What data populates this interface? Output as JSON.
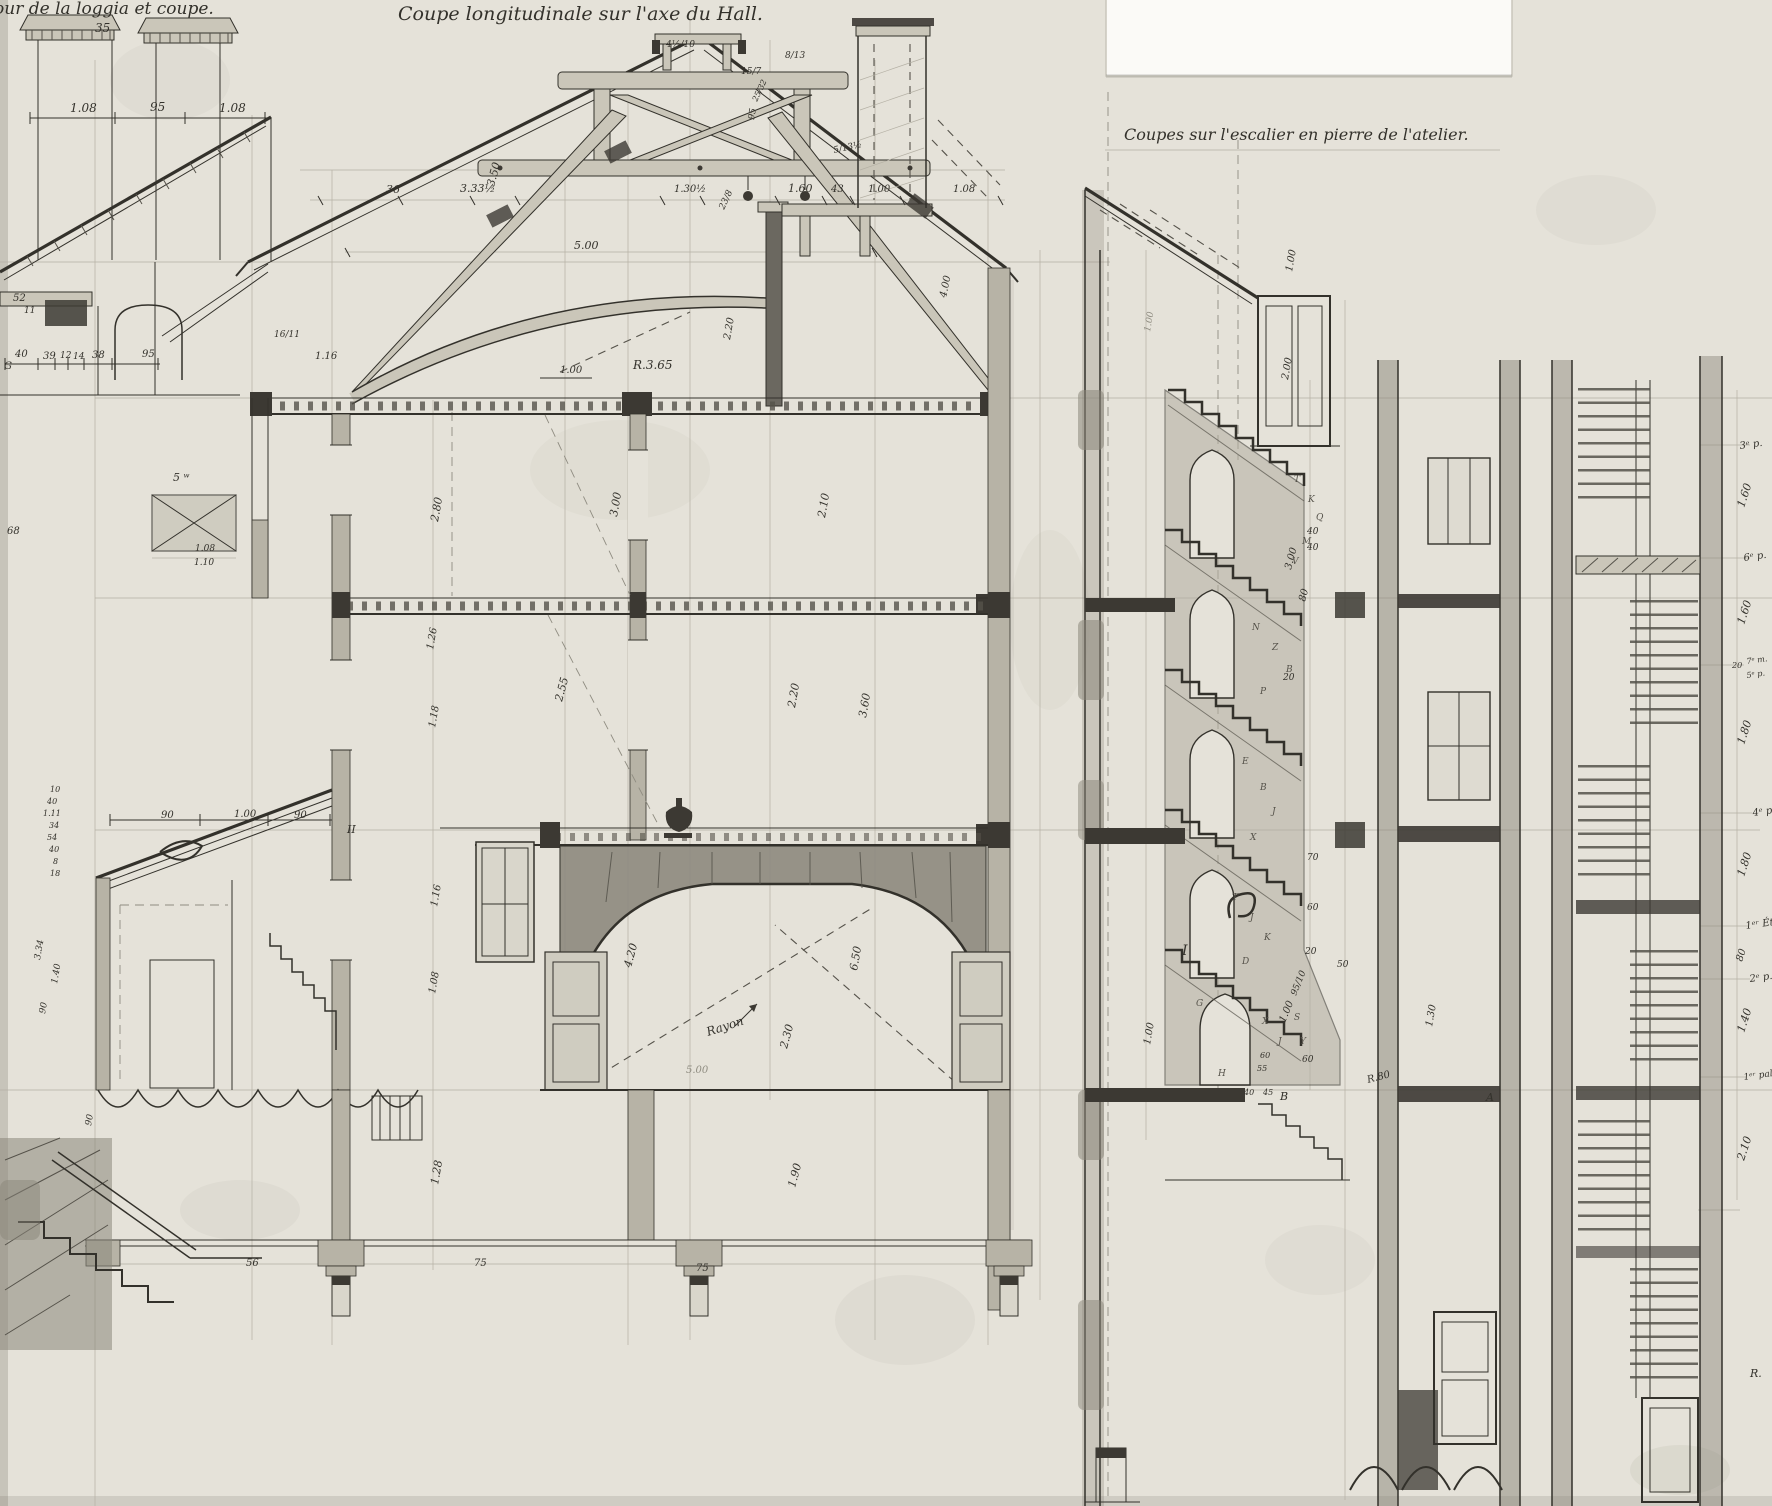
{
  "titles": {
    "left": "Tour de la loggia et coupe.",
    "center": "Coupe longitudinale sur l'axe du Hall.",
    "right": "Coupes sur l'escalier en pierre de l'atelier."
  },
  "colors": {
    "paper": "#e5e2d9",
    "ink": "#33312b",
    "wash": "#8a867a",
    "wood": "#cac6b9",
    "stone": "#b3afa2",
    "dark_fill": "#3c3933",
    "white_patch": "#fbfaf7"
  },
  "labels": [
    {
      "t": "35",
      "x": 95,
      "y": 32,
      "s": 12
    },
    {
      "t": "1.08",
      "x": 70,
      "y": 112,
      "s": 12
    },
    {
      "t": "95",
      "x": 150,
      "y": 111,
      "s": 12
    },
    {
      "t": "1.08",
      "x": 219,
      "y": 112,
      "s": 12
    },
    {
      "t": "52",
      "x": 13,
      "y": 301,
      "s": 10
    },
    {
      "t": "11",
      "x": 24,
      "y": 313,
      "s": 9
    },
    {
      "t": "G",
      "x": 4,
      "y": 369,
      "s": 10
    },
    {
      "t": "40",
      "x": 15,
      "y": 357,
      "s": 10
    },
    {
      "t": "39",
      "x": 43,
      "y": 359,
      "s": 10
    },
    {
      "t": "12",
      "x": 60,
      "y": 358,
      "s": 9
    },
    {
      "t": "14",
      "x": 73,
      "y": 359,
      "s": 9
    },
    {
      "t": "38",
      "x": 92,
      "y": 358,
      "s": 10
    },
    {
      "t": "95",
      "x": 142,
      "y": 357,
      "s": 10
    },
    {
      "t": "5 ʷ",
      "x": 173,
      "y": 481,
      "s": 11
    },
    {
      "t": "68",
      "x": 7,
      "y": 534,
      "s": 10
    },
    {
      "t": "1.08",
      "x": 195,
      "y": 551,
      "s": 9
    },
    {
      "t": "1.10",
      "x": 194,
      "y": 565,
      "s": 9
    },
    {
      "t": "36",
      "x": 386,
      "y": 193,
      "s": 11
    },
    {
      "t": "3.33½",
      "x": 460,
      "y": 192,
      "s": 11
    },
    {
      "t": "3.50",
      "x": 494,
      "y": 187,
      "r": -75,
      "s": 11
    },
    {
      "t": "1.30½",
      "x": 674,
      "y": 192,
      "s": 10
    },
    {
      "t": "1.60",
      "x": 788,
      "y": 192,
      "s": 11
    },
    {
      "t": "43",
      "x": 831,
      "y": 192,
      "s": 10
    },
    {
      "t": "1.00",
      "x": 868,
      "y": 192,
      "s": 10
    },
    {
      "t": "1.08",
      "x": 953,
      "y": 192,
      "s": 10
    },
    {
      "t": "5.00",
      "x": 574,
      "y": 249,
      "s": 11
    },
    {
      "t": "4.00",
      "x": 946,
      "y": 298,
      "r": -78,
      "s": 10
    },
    {
      "t": "R.3.65",
      "x": 633,
      "y": 369,
      "s": 12
    },
    {
      "t": "1.00",
      "x": 560,
      "y": 373,
      "s": 10
    },
    {
      "t": "2.20",
      "x": 730,
      "y": 340,
      "r": -80,
      "s": 10
    },
    {
      "t": "4½/10",
      "x": 666,
      "y": 47,
      "s": 9
    },
    {
      "t": "8/13",
      "x": 785,
      "y": 58,
      "s": 9
    },
    {
      "t": "15/7",
      "x": 741,
      "y": 74,
      "s": 9
    },
    {
      "t": "95",
      "x": 754,
      "y": 120,
      "r": -80,
      "s": 9
    },
    {
      "t": "25/32",
      "x": 757,
      "y": 102,
      "r": -65,
      "s": 8
    },
    {
      "t": "5/13½",
      "x": 834,
      "y": 153,
      "r": -12,
      "s": 9
    },
    {
      "t": "23/8",
      "x": 724,
      "y": 210,
      "r": -65,
      "s": 9
    },
    {
      "t": "16/11",
      "x": 274,
      "y": 337,
      "s": 9
    },
    {
      "t": "1.16",
      "x": 315,
      "y": 359,
      "s": 10
    },
    {
      "t": "2.80",
      "x": 438,
      "y": 522,
      "r": -80,
      "s": 11
    },
    {
      "t": "3.00",
      "x": 617,
      "y": 517,
      "r": -80,
      "s": 11
    },
    {
      "t": "2.10",
      "x": 825,
      "y": 518,
      "r": -80,
      "s": 11
    },
    {
      "t": "1.26",
      "x": 433,
      "y": 650,
      "r": -80,
      "s": 10
    },
    {
      "t": "1.18",
      "x": 435,
      "y": 728,
      "r": -80,
      "s": 10
    },
    {
      "t": "2.55",
      "x": 562,
      "y": 702,
      "r": -75,
      "s": 11
    },
    {
      "t": "2.20",
      "x": 795,
      "y": 708,
      "r": -80,
      "s": 11
    },
    {
      "t": "3.60",
      "x": 866,
      "y": 718,
      "r": -80,
      "s": 11
    },
    {
      "t": "1.16",
      "x": 437,
      "y": 907,
      "r": -80,
      "s": 10
    },
    {
      "t": "1.08",
      "x": 435,
      "y": 994,
      "r": -80,
      "s": 10
    },
    {
      "t": "4.20",
      "x": 631,
      "y": 968,
      "r": -75,
      "s": 11
    },
    {
      "t": "6.50",
      "x": 857,
      "y": 971,
      "r": -80,
      "s": 11
    },
    {
      "t": "Rayon",
      "x": 708,
      "y": 1036,
      "r": -18,
      "s": 12
    },
    {
      "t": "2.30",
      "x": 787,
      "y": 1049,
      "r": -75,
      "s": 11
    },
    {
      "t": "5.00",
      "x": 686,
      "y": 1073,
      "s": 10,
      "c": "faint"
    },
    {
      "t": "1.28",
      "x": 438,
      "y": 1185,
      "r": -80,
      "s": 11
    },
    {
      "t": "1.90",
      "x": 795,
      "y": 1188,
      "r": -75,
      "s": 11
    },
    {
      "t": "56",
      "x": 246,
      "y": 1266,
      "s": 10
    },
    {
      "t": "75",
      "x": 474,
      "y": 1266,
      "s": 10
    },
    {
      "t": "75",
      "x": 696,
      "y": 1271,
      "s": 10
    },
    {
      "t": "90",
      "x": 161,
      "y": 818,
      "s": 10
    },
    {
      "t": "1.00",
      "x": 234,
      "y": 817,
      "s": 10
    },
    {
      "t": "90",
      "x": 294,
      "y": 818,
      "s": 10
    },
    {
      "t": "II",
      "x": 347,
      "y": 833,
      "s": 11
    },
    {
      "t": "10",
      "x": 50,
      "y": 792,
      "s": 8
    },
    {
      "t": "40",
      "x": 47,
      "y": 804,
      "s": 8
    },
    {
      "t": "1.11",
      "x": 43,
      "y": 816,
      "s": 8
    },
    {
      "t": "34",
      "x": 49,
      "y": 828,
      "s": 8
    },
    {
      "t": "54",
      "x": 47,
      "y": 840,
      "s": 8
    },
    {
      "t": "40",
      "x": 49,
      "y": 852,
      "s": 8
    },
    {
      "t": "8",
      "x": 53,
      "y": 864,
      "s": 8
    },
    {
      "t": "18",
      "x": 50,
      "y": 876,
      "s": 8
    },
    {
      "t": "3.34",
      "x": 40,
      "y": 960,
      "r": -80,
      "s": 9
    },
    {
      "t": "1.40",
      "x": 57,
      "y": 984,
      "r": -80,
      "s": 9
    },
    {
      "t": "90",
      "x": 45,
      "y": 1014,
      "r": -80,
      "s": 9
    },
    {
      "t": "90",
      "x": 91,
      "y": 1126,
      "r": -80,
      "s": 9
    },
    {
      "t": "1.00",
      "x": 1292,
      "y": 272,
      "r": -80,
      "s": 10
    },
    {
      "t": "2.00",
      "x": 1288,
      "y": 380,
      "r": -80,
      "s": 10
    },
    {
      "t": "3.00",
      "x": 1291,
      "y": 570,
      "r": -75,
      "s": 10
    },
    {
      "t": "40",
      "x": 1307,
      "y": 534,
      "s": 9
    },
    {
      "t": "40",
      "x": 1307,
      "y": 550,
      "s": 9
    },
    {
      "t": "80",
      "x": 1305,
      "y": 602,
      "r": -75,
      "s": 10
    },
    {
      "t": "20",
      "x": 1283,
      "y": 680,
      "s": 9
    },
    {
      "t": "70",
      "x": 1307,
      "y": 860,
      "s": 9
    },
    {
      "t": "60",
      "x": 1307,
      "y": 910,
      "s": 9
    },
    {
      "t": "20",
      "x": 1305,
      "y": 954,
      "s": 9
    },
    {
      "t": "50",
      "x": 1337,
      "y": 967,
      "s": 9
    },
    {
      "t": "95/10",
      "x": 1296,
      "y": 996,
      "r": -68,
      "s": 9
    },
    {
      "t": "1.00",
      "x": 1285,
      "y": 1023,
      "r": -68,
      "s": 10
    },
    {
      "t": "60",
      "x": 1302,
      "y": 1062,
      "s": 9
    },
    {
      "t": "R.80",
      "x": 1368,
      "y": 1083,
      "r": -15,
      "s": 10
    },
    {
      "t": "1.30",
      "x": 1432,
      "y": 1027,
      "r": -80,
      "s": 10
    },
    {
      "t": "1.00",
      "x": 1150,
      "y": 1045,
      "r": -80,
      "s": 10
    },
    {
      "t": "1.00",
      "x": 1150,
      "y": 332,
      "r": -80,
      "s": 9,
      "c": "faint"
    },
    {
      "t": "60",
      "x": 1260,
      "y": 1058,
      "s": 8
    },
    {
      "t": "55",
      "x": 1257,
      "y": 1071,
      "s": 8
    },
    {
      "t": "40",
      "x": 1244,
      "y": 1095,
      "s": 8
    },
    {
      "t": "45",
      "x": 1263,
      "y": 1095,
      "s": 8
    },
    {
      "t": "B",
      "x": 1280,
      "y": 1100,
      "s": 11
    },
    {
      "t": "A",
      "x": 1486,
      "y": 1101,
      "s": 11
    },
    {
      "t": "I",
      "x": 1182,
      "y": 955,
      "s": 14
    },
    {
      "t": "T",
      "x": 1294,
      "y": 482,
      "s": 9,
      "c": "letter"
    },
    {
      "t": "K",
      "x": 1308,
      "y": 502,
      "s": 9,
      "c": "letter"
    },
    {
      "t": "Q",
      "x": 1316,
      "y": 520,
      "s": 9,
      "c": "letter"
    },
    {
      "t": "M",
      "x": 1302,
      "y": 544,
      "s": 9,
      "c": "letter"
    },
    {
      "t": "V",
      "x": 1292,
      "y": 564,
      "s": 9,
      "c": "letter"
    },
    {
      "t": "N",
      "x": 1252,
      "y": 630,
      "s": 9,
      "c": "letter"
    },
    {
      "t": "Z",
      "x": 1272,
      "y": 650,
      "s": 9,
      "c": "letter"
    },
    {
      "t": "B",
      "x": 1286,
      "y": 672,
      "s": 9,
      "c": "letter"
    },
    {
      "t": "P",
      "x": 1260,
      "y": 694,
      "s": 9,
      "c": "letter"
    },
    {
      "t": "E",
      "x": 1242,
      "y": 764,
      "s": 9,
      "c": "letter"
    },
    {
      "t": "B",
      "x": 1260,
      "y": 790,
      "s": 9,
      "c": "letter"
    },
    {
      "t": "J",
      "x": 1272,
      "y": 814,
      "s": 9,
      "c": "letter"
    },
    {
      "t": "X",
      "x": 1250,
      "y": 840,
      "s": 9,
      "c": "letter"
    },
    {
      "t": "T",
      "x": 1232,
      "y": 900,
      "s": 9,
      "c": "letter"
    },
    {
      "t": "J",
      "x": 1250,
      "y": 920,
      "s": 9,
      "c": "letter"
    },
    {
      "t": "K",
      "x": 1264,
      "y": 940,
      "s": 9,
      "c": "letter"
    },
    {
      "t": "D",
      "x": 1242,
      "y": 964,
      "s": 9,
      "c": "letter"
    },
    {
      "t": "X",
      "x": 1262,
      "y": 1024,
      "s": 9,
      "c": "letter"
    },
    {
      "t": "J",
      "x": 1278,
      "y": 1044,
      "s": 9,
      "c": "letter"
    },
    {
      "t": "H",
      "x": 1218,
      "y": 1076,
      "s": 9,
      "c": "letter"
    },
    {
      "t": "S",
      "x": 1294,
      "y": 1020,
      "s": 9,
      "c": "letter"
    },
    {
      "t": "Y",
      "x": 1300,
      "y": 1044,
      "s": 9,
      "c": "letter"
    },
    {
      "t": "G",
      "x": 1196,
      "y": 1006,
      "s": 9,
      "c": "letter"
    },
    {
      "t": "3ᵉ p.",
      "x": 1740,
      "y": 449,
      "r": -8,
      "s": 10
    },
    {
      "t": "1.60",
      "x": 1744,
      "y": 508,
      "r": -72,
      "s": 11
    },
    {
      "t": "6ᵉ p.",
      "x": 1744,
      "y": 561,
      "r": -8,
      "s": 10
    },
    {
      "t": "1.60",
      "x": 1744,
      "y": 625,
      "r": -72,
      "s": 11
    },
    {
      "t": "20",
      "x": 1732,
      "y": 668,
      "s": 8
    },
    {
      "t": "7ᵉ m.",
      "x": 1747,
      "y": 664,
      "r": -8,
      "s": 8
    },
    {
      "t": "5ᵉ p.",
      "x": 1747,
      "y": 678,
      "r": -8,
      "s": 8
    },
    {
      "t": "1.80",
      "x": 1744,
      "y": 745,
      "r": -72,
      "s": 11
    },
    {
      "t": "4ᵉ p.",
      "x": 1753,
      "y": 816,
      "r": -8,
      "s": 10
    },
    {
      "t": "1.80",
      "x": 1744,
      "y": 877,
      "r": -72,
      "s": 11
    },
    {
      "t": "1ᵉʳ Ét.",
      "x": 1746,
      "y": 929,
      "r": -8,
      "s": 10
    },
    {
      "t": "80",
      "x": 1742,
      "y": 962,
      "r": -72,
      "s": 10
    },
    {
      "t": "2ᵉ p.",
      "x": 1750,
      "y": 982,
      "r": -8,
      "s": 10
    },
    {
      "t": "1.40",
      "x": 1744,
      "y": 1033,
      "r": -72,
      "s": 11
    },
    {
      "t": "1ᵉʳ pal.",
      "x": 1744,
      "y": 1080,
      "r": -8,
      "s": 9
    },
    {
      "t": "2.10",
      "x": 1744,
      "y": 1161,
      "r": -72,
      "s": 11
    },
    {
      "t": "R.",
      "x": 1750,
      "y": 1377,
      "s": 11
    }
  ]
}
